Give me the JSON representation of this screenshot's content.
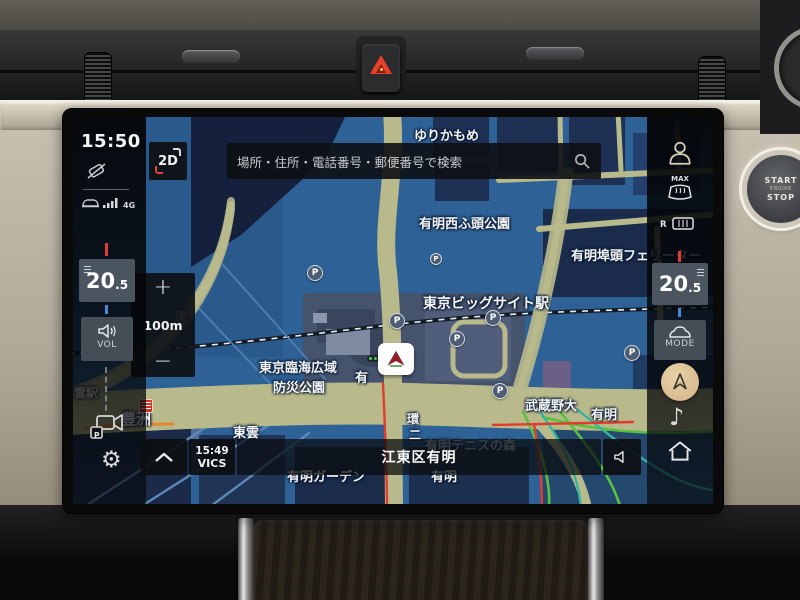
{
  "screen": {
    "status": {
      "time": "15:50",
      "network_label": "4G"
    },
    "view_button": {
      "label": "2D"
    },
    "search": {
      "placeholder": "場所・住所・電話番号・郵便番号で検索"
    },
    "zoom": {
      "plus": "+",
      "scale": "100m",
      "minus": "−"
    },
    "left_climate": {
      "temp_main": "20",
      "temp_frac": ".5"
    },
    "volume_button": {
      "label": "VOL"
    },
    "right_climate": {
      "max": "MAX",
      "rear": "R",
      "temp_main": "20",
      "temp_frac": ".5",
      "mode": "MODE"
    },
    "bottom": {
      "vics_time": "15:49",
      "vics": "VICS",
      "location": "江東区有明"
    }
  },
  "hardware": {
    "start": {
      "line1": "START",
      "line2": "ENGINE",
      "line3": "STOP"
    }
  },
  "icons": {
    "gear": "⚙",
    "note": "♪"
  },
  "map": {
    "parking_label": "P",
    "labels": [
      {
        "t": "ゆりかもめ",
        "x": 341,
        "y": 8,
        "s": 13
      },
      {
        "t": "有明西ふ頭公園",
        "x": 346,
        "y": 96,
        "s": 13
      },
      {
        "t": "有明埠頭フェリーター",
        "x": 498,
        "y": 128,
        "s": 13
      },
      {
        "t": "東京ビッグサイト駅",
        "x": 350,
        "y": 176,
        "s": 14,
        "b": 1
      },
      {
        "t": "東京臨海広域",
        "x": 186,
        "y": 240,
        "s": 13
      },
      {
        "t": "防災公園",
        "x": 200,
        "y": 260,
        "s": 13
      },
      {
        "t": "有",
        "x": 282,
        "y": 250,
        "s": 13
      },
      {
        "t": "武蔵野大",
        "x": 452,
        "y": 278,
        "s": 13,
        "b": 1
      },
      {
        "t": "有明",
        "x": 518,
        "y": 287,
        "s": 13
      },
      {
        "t": "豊洲",
        "x": 48,
        "y": 291,
        "s": 15,
        "b": 1
      },
      {
        "t": "東雲",
        "x": 160,
        "y": 305,
        "s": 13
      },
      {
        "t": "雲駅",
        "x": 1,
        "y": 267,
        "s": 12,
        "o": 0.8
      },
      {
        "t": "便",
        "x": 102,
        "y": 190,
        "s": 12
      },
      {
        "t": "環",
        "x": 334,
        "y": 293,
        "s": 12
      },
      {
        "t": "二",
        "x": 336,
        "y": 309,
        "s": 12
      },
      {
        "t": "有明テニスの森",
        "x": 352,
        "y": 318,
        "s": 13,
        "o": 0.7
      },
      {
        "t": "有明ガーデン",
        "x": 214,
        "y": 349,
        "s": 13
      },
      {
        "t": "有明",
        "x": 358,
        "y": 349,
        "s": 13
      }
    ],
    "parking": [
      {
        "x": 234,
        "y": 148
      },
      {
        "x": 316,
        "y": 196
      },
      {
        "x": 412,
        "y": 193
      },
      {
        "x": 376,
        "y": 214
      },
      {
        "x": 419,
        "y": 266
      },
      {
        "x": 551,
        "y": 228
      },
      {
        "x": 357,
        "y": 136,
        "small": 1
      }
    ],
    "colors": {
      "map_base": "#2e6296",
      "road": "#b9ba8c",
      "traffic_free": "#58c23e",
      "traffic_moderate": "#36b49e",
      "traffic_congested": "#e23b2e",
      "compass_bg": "#d9bd90",
      "hazard_red": "#e8402a"
    }
  }
}
